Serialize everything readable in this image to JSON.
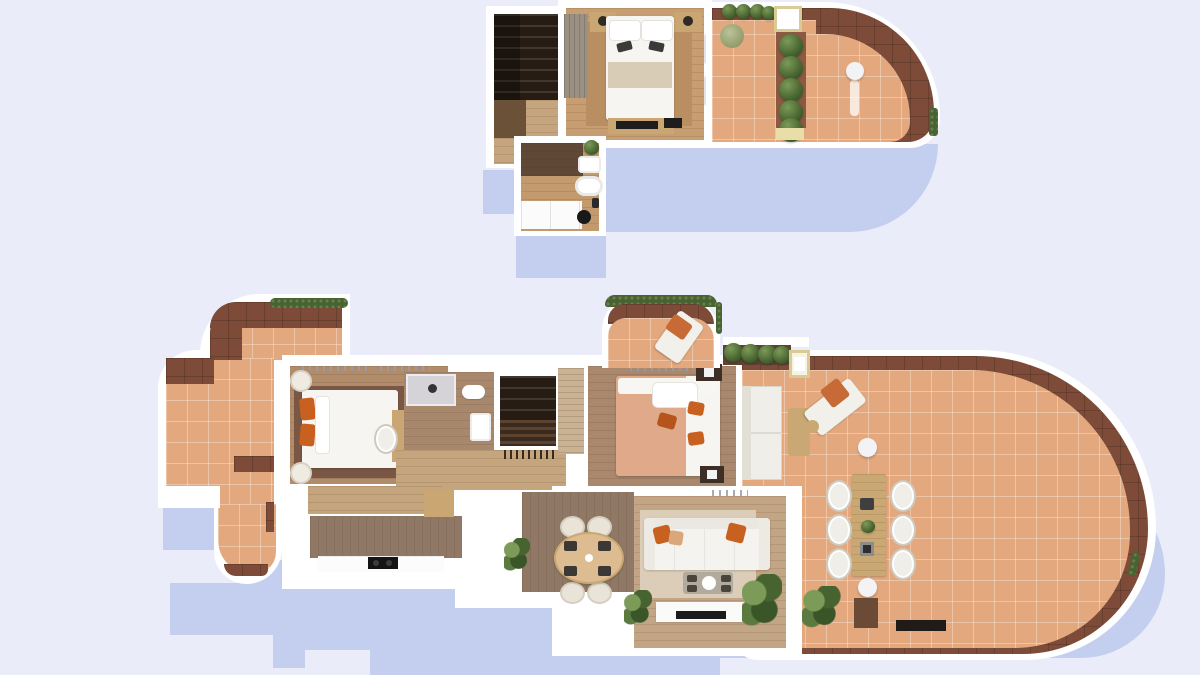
{
  "meta": {
    "description": "Top-down 3D architectural render of a two-level duplex apartment floor plan on a pale lavender background with soft cast shadows",
    "levels": 2,
    "render_style": "photoreal top-down dollhouse view, no text labels"
  },
  "palette": {
    "bg": "#EAEDF9",
    "shadow": "#C4CEEE",
    "wall": "#FFFFFF",
    "terracotta": "#E3A87E",
    "tiledark": "#7D4B38",
    "hedge": "#47632F",
    "bushlight": "#7C9A58",
    "olive": "#97A473",
    "woodfloor": "#C79E71",
    "woodrug": "#B98F62",
    "woodlight": "#C4A57D",
    "wooddeck": "#8F7866",
    "wooddesk": "#C9A672",
    "tablewood": "#C9A873",
    "stairdark": "#261C14",
    "stairmid": "#6B5138",
    "bedwhite": "#F6F5F2",
    "beige": "#D9CCB6",
    "orange": "#C8611F",
    "salmon": "#DFA98A",
    "nsdark": "#3E2F26",
    "black": "#161412",
    "chairwhite": "#F0EEE9",
    "chaircream": "#EAE4D8",
    "glass": "#ACA69B",
    "shower": "#D6D3D8",
    "bathdark": "#5F4836",
    "bathfloor": "#C29A6E",
    "b1floor": "#B18C6B",
    "b1rug": "#7A5744",
    "b2floor": "#A9886E",
    "lvfloor": "#C2A585",
    "lvrug": "#DBCDB7",
    "cream": "#EFE7C6",
    "creamframe": "#D9CB96",
    "wardrobe": "#9B9183",
    "wardrobe2": "#CBB293"
  },
  "floors": [
    {
      "id": "upper-floor",
      "position": "top of image",
      "rooms": [
        {
          "name": "staircase",
          "furniture": [
            "winder-stairs",
            "wood-landing"
          ]
        },
        {
          "name": "bedroom",
          "furniture": [
            "wardrobe",
            "double-bed",
            "two-nightstands-with-lamps",
            "tv-sideboard",
            "bench",
            "area-rug",
            "curtains"
          ]
        },
        {
          "name": "bathroom",
          "furniture": [
            "washbasin",
            "bathtub",
            "vanity-cabinet",
            "black-stool",
            "plant"
          ]
        },
        {
          "name": "roof-terrace",
          "furniture": [
            "hedge-planter",
            "small-tree",
            "white-planter-box",
            "topiary-row",
            "round-side-table"
          ]
        }
      ]
    },
    {
      "id": "main-floor",
      "position": "bottom of image",
      "rooms": [
        {
          "name": "west-terrace",
          "furniture": [
            "hedge",
            "dark-tile-borders"
          ]
        },
        {
          "name": "bedroom-1",
          "furniture": [
            "double-bed-orange-pillows",
            "two-round-side-tables",
            "desk",
            "chair",
            "dark-rug"
          ]
        },
        {
          "name": "ensuite-bathroom",
          "furniture": [
            "shower",
            "toilet",
            "washbasin"
          ]
        },
        {
          "name": "staircase",
          "furniture": [
            "railing"
          ]
        },
        {
          "name": "hall",
          "furniture": [
            "wardrobe"
          ]
        },
        {
          "name": "bedroom-2",
          "furniture": [
            "double-bed-salmon-duvet",
            "two-dark-nightstands"
          ]
        },
        {
          "name": "north-balcony",
          "furniture": [
            "sun-lounger-orange-cushion",
            "hedge-arc"
          ]
        },
        {
          "name": "kitchen",
          "furniture": [
            "island-counter",
            "white-counter",
            "black-cooktop",
            "base-cabinet"
          ]
        },
        {
          "name": "dining-area",
          "furniture": [
            "oval-table",
            "four-cream-chairs",
            "dark-placemats",
            "plant"
          ]
        },
        {
          "name": "living-room",
          "furniture": [
            "white-sofa-orange-cushions",
            "coffee-table",
            "tv-console",
            "television",
            "two-plants",
            "cream-rug"
          ]
        },
        {
          "name": "east-terrace",
          "furniture": [
            "outdoor-sofa",
            "wood-coffee-table",
            "sun-lounger",
            "round-side-table",
            "dining-table-for-six",
            "six-white-chairs",
            "planter-with-topiary",
            "cream-planter-box",
            "white-stools",
            "walkway-strip",
            "plant",
            "dark-step"
          ]
        }
      ]
    }
  ]
}
